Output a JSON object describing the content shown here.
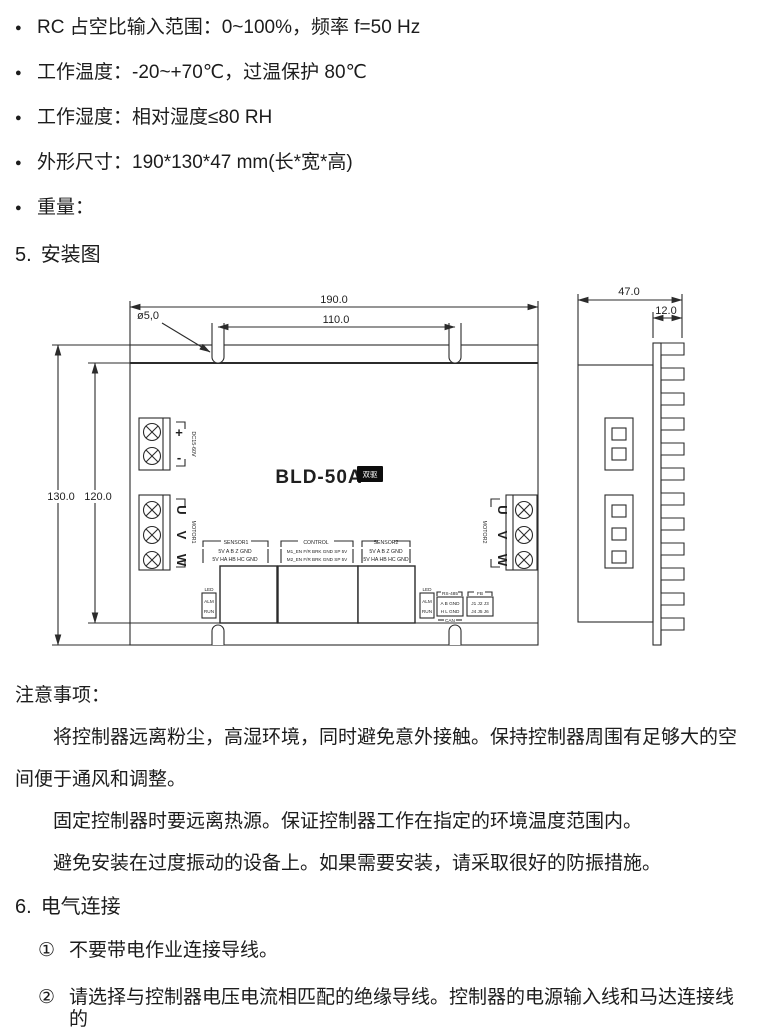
{
  "specs": {
    "bullet": "●",
    "items": [
      "RC 占空比输入范围：0~100%，频率 f=50 Hz",
      "工作温度：-20~+70℃，过温保护 80℃",
      "工作湿度：相对湿度≤80 RH",
      "外形尺寸：190*130*47 mm(长*宽*高)",
      "重量："
    ]
  },
  "section5": {
    "number": "5.",
    "title": "安装图"
  },
  "drawing": {
    "dims": {
      "width": "190.0",
      "slot_span": "110.0",
      "hole": "ø5,0",
      "height": "130.0",
      "inner_height": "120.0",
      "depth": "47.0",
      "fin_depth": "12.0"
    },
    "model": "BLD-50A",
    "badge": "双驱",
    "power": {
      "plus": "+",
      "minus": "-",
      "rating": "DC15-60V"
    },
    "motor1": {
      "u": "U",
      "v": "V",
      "w": "W",
      "label": "MOTOR1"
    },
    "motor2": {
      "u": "U",
      "v": "V",
      "w": "W",
      "label": "MOTOR2"
    },
    "sensor1": {
      "title": "SENSOR1",
      "row1": "5V A  B  Z GND",
      "row2": "5V HA HB HC GND"
    },
    "control": {
      "title": "CONTROL",
      "row1": "M1_EN F/R BRK GND SP 5V",
      "row2": "M2_EN F/R BRK GND SP 5V"
    },
    "sensor2": {
      "title": "SENSOR2",
      "row1": "5V A  B  Z GND",
      "row2": "5V HA HB HC GND"
    },
    "led1": {
      "title": "LED",
      "row1": "ALM",
      "row2": "RUN"
    },
    "led2": {
      "title": "LED",
      "row1": "ALM",
      "row2": "RUN"
    },
    "rs485": {
      "title": "RS-485",
      "row1": "A  B GND",
      "row2": "H  L GND",
      "footer": "CAN"
    },
    "fb": {
      "title": "FB",
      "row1": "J1 J2 J3",
      "row2": "J4 J5 J6"
    }
  },
  "notes": {
    "title": "注意事项：",
    "p1": "将控制器远离粉尘，高湿环境，同时避免意外接触。保持控制器周围有足够大的空间便于通风和调整。",
    "p2": "固定控制器时要远离热源。保证控制器工作在指定的环境温度范围内。",
    "p3": "避免安装在过度振动的设备上。如果需要安装，请采取很好的防振措施。"
  },
  "section6": {
    "number": "6.",
    "title": "电气连接",
    "items": [
      {
        "marker": "①",
        "text": "不要带电作业连接导线。"
      },
      {
        "marker": "②",
        "text": "请选择与控制器电压电流相匹配的绝缘导线。控制器的电源输入线和马达连接线的"
      }
    ]
  }
}
